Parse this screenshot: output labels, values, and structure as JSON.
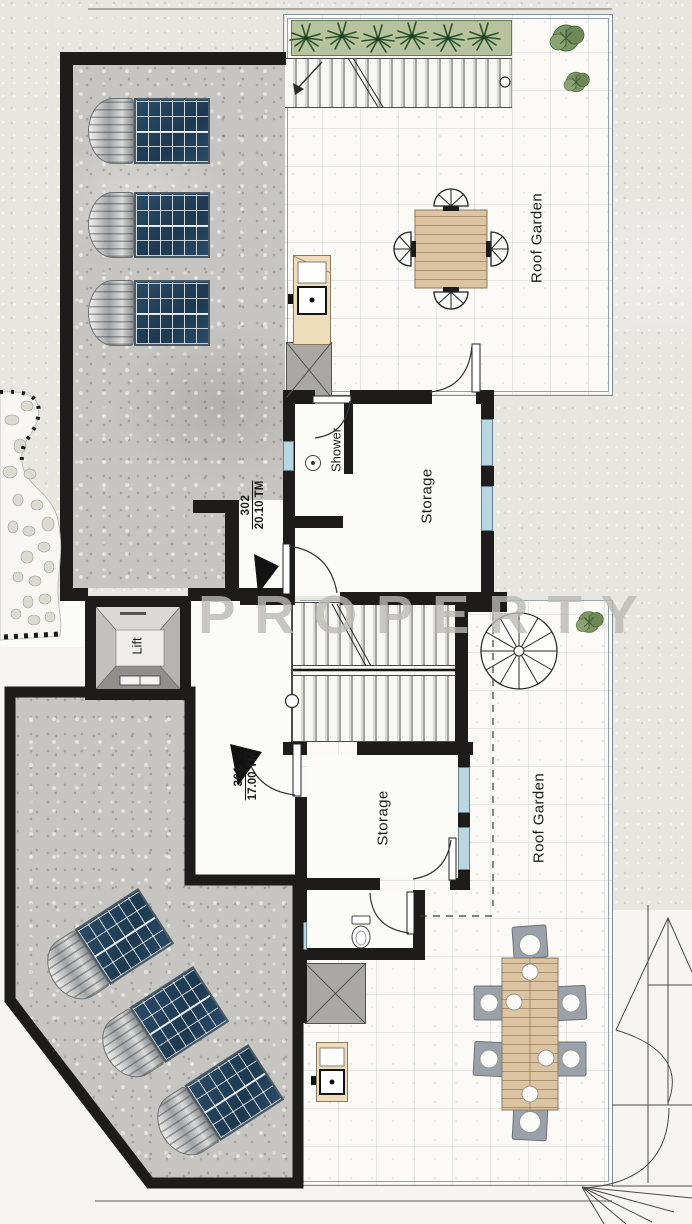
{
  "plan": {
    "watermark": "PROPERTY",
    "rooms": {
      "roof_garden_upper": "Roof Garden",
      "roof_garden_lower": "Roof Garden",
      "storage_upper": "Storage",
      "storage_lower": "Storage",
      "shower": "Shower",
      "lift": "Lift"
    },
    "units": {
      "u302": {
        "number": "302",
        "area": "20.10 TM"
      },
      "u301": {
        "number": "301",
        "area": "17.00 TM"
      }
    },
    "colors": {
      "wall": "#1d1c1a",
      "concrete": "#c6c5c1",
      "paper": "#e7e6e1",
      "room_floor": "#fbfaf6",
      "window": "#b9d7e3",
      "lounger_mat": "#24425c",
      "wood": "#d6b896",
      "plant_green": "#5d7c4c",
      "watermark_gray": "#bdbcb8"
    }
  }
}
